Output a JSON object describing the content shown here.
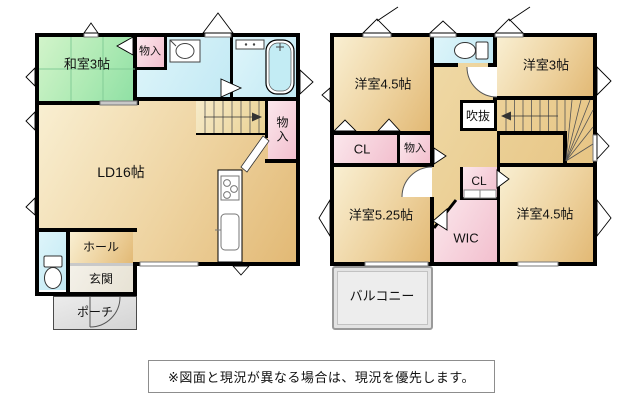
{
  "floor1": {
    "rooms": {
      "washitsu": "和室3帖",
      "storage_top": "物入",
      "living_dining": "LD16帖",
      "storage_side": "物入",
      "hall": "ホール",
      "entrance": "玄関",
      "porch": "ポーチ"
    }
  },
  "floor2": {
    "rooms": {
      "bedroom_nw": "洋室4.5帖",
      "bedroom_ne": "洋室3帖",
      "void": "吹抜",
      "closet_left": "CL",
      "storage": "物入",
      "closet_center": "CL",
      "wic": "WIC",
      "bedroom_sw": "洋室5.25帖",
      "bedroom_se": "洋室4.5帖",
      "balcony": "バルコニー"
    }
  },
  "note": {
    "text": "※図面と現況が異なる場合は、現況を優先します。"
  },
  "palette": {
    "wall": "#000000",
    "room_tan": "#e2b975",
    "room_tan_light": "#f9efd2",
    "tatami_green": "#8fe0a4",
    "water_cyan": "#cdeef7",
    "closet_pink": "#f2bfce",
    "exterior_gray": "#e3e3e3"
  }
}
